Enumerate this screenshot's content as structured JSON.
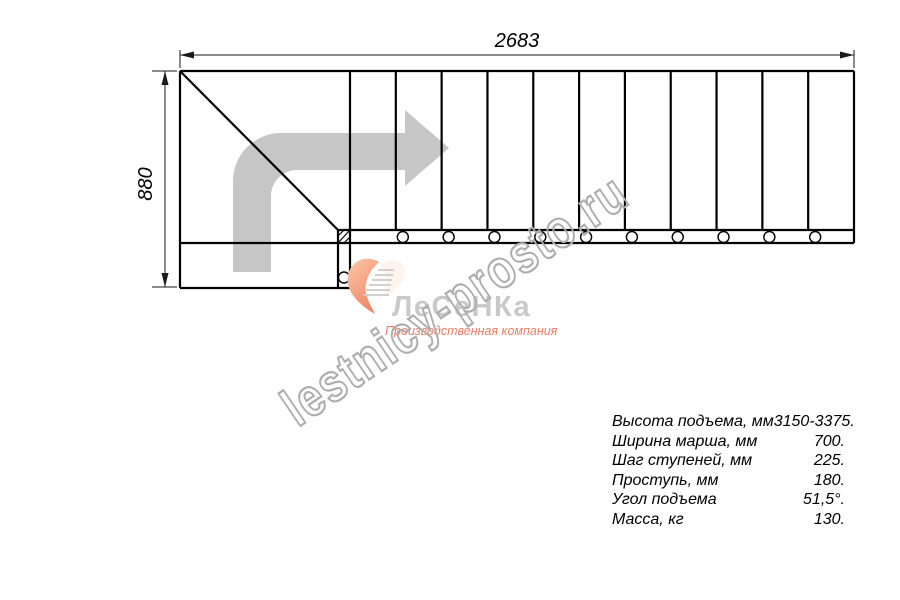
{
  "drawing": {
    "type": "staircase-plan-top-view",
    "width_label": "2683",
    "height_label": "880",
    "steps_in_main_run": 11,
    "bolt_holes_in_run": 10,
    "bolt_holes_in_entry": 1,
    "colors": {
      "line": "#000000",
      "dimension": "#1a1a1a",
      "direction_arrow": "#c6c6c6"
    }
  },
  "watermark": {
    "text": "lestnicy-prosto.ru",
    "color": "#adadad"
  },
  "logo": {
    "name": "ЛеСеНКа",
    "subtitle": "Производственная компания",
    "name_color": "#c9c9c9",
    "subtitle_color": "#ee7e63",
    "swoosh_colors": [
      "#fbc9a9",
      "#ef8767"
    ],
    "icon": "stair-swoosh-icon"
  },
  "specs": {
    "rows": [
      {
        "label": "Высота подъема, мм",
        "value": "3150-3375."
      },
      {
        "label": "Ширина марша, мм",
        "value": "700."
      },
      {
        "label": "Шаг ступеней, мм",
        "value": "225."
      },
      {
        "label": "Проступь, мм",
        "value": "180."
      },
      {
        "label": "Угол подъема",
        "value": "51,5°."
      },
      {
        "label": "Масса, кг",
        "value": "130."
      }
    ]
  }
}
